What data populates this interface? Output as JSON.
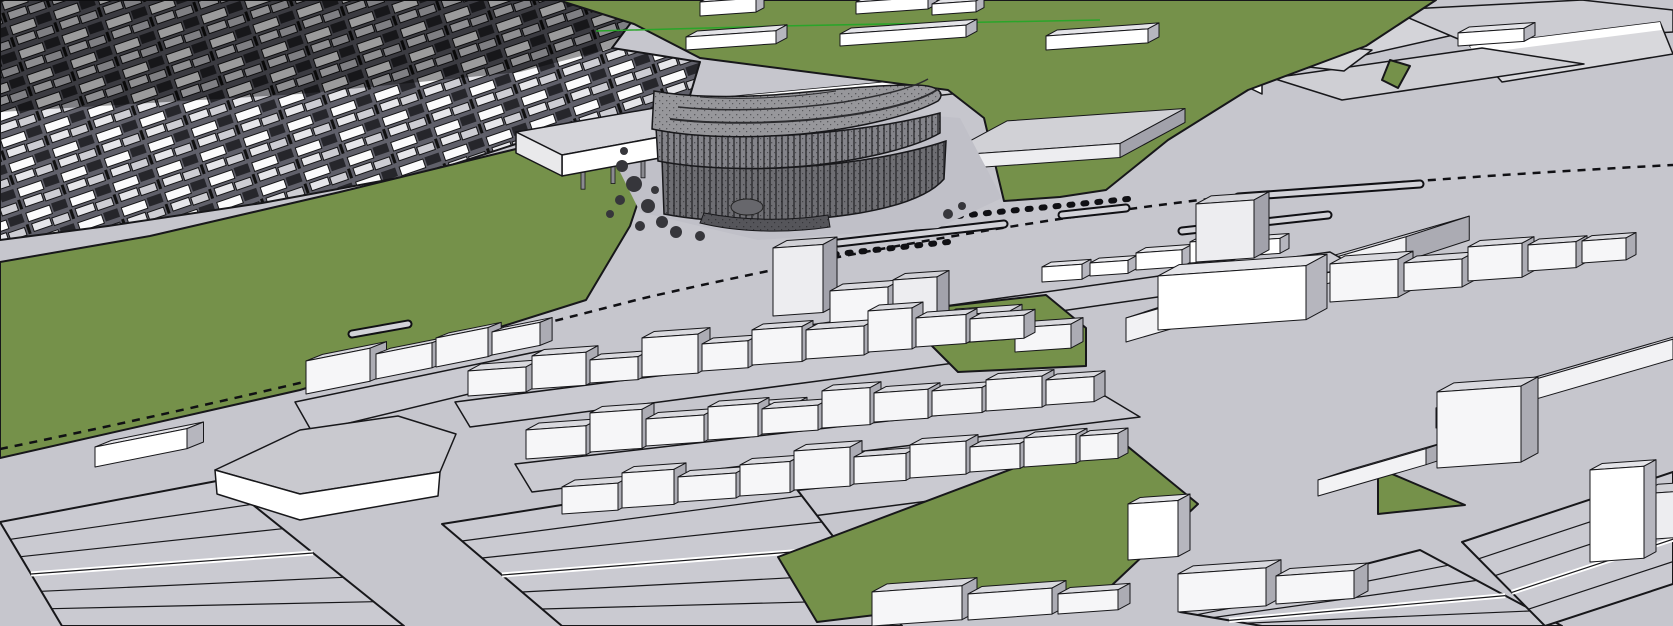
{
  "meta": {
    "description": "3D city massing model viewport with one detailed dark building among white block massing, green parks and gray streets",
    "view": "aerial perspective"
  },
  "colors": {
    "road": "#C6C6CD",
    "plot": "#CACAD1",
    "plaza": "#C0C0C8",
    "green": "#75914A",
    "outline": "#17171A",
    "axisGreen": "#2AA52A",
    "railBlack": "#101014",
    "denseOverlay": "#000000",
    "variants": {
      "d": {
        "t": "#D9D9DE",
        "f": "#F6F6F8",
        "s": "#ACACB4"
      },
      "w": {
        "t": "#E4E4E8",
        "f": "#FFFFFF",
        "s": "#B6B6BE"
      },
      "g": {
        "t": "#D1D1D6",
        "f": "#EDEDF0",
        "s": "#A2A2AB"
      },
      "G": {
        "t": "#CFCFD5",
        "f": "#F2F2F4",
        "s": "#ABABB3"
      },
      "b": {
        "t": "#DADAE0",
        "f": "#C8DEEC",
        "s": "#A8A8B0"
      }
    }
  },
  "scene": {
    "dense": {
      "name": "dense-neighborhood",
      "pts": "0,0 648,0 612,48 700,62 688,102 565,128 430,172 262,203 108,226 0,240",
      "darkPts": "0,0 648,0 612,48 520,72 300,94 0,112",
      "darkOpacity": 0.38
    },
    "regions": [
      {
        "name": "left-park",
        "pts": "0,262 150,236 340,192 520,148 592,133 658,142 630,226 586,300 300,390 0,458",
        "fill": "green",
        "stroke": true
      },
      {
        "name": "top-green-field",
        "pts": "558,0 1436,0 1366,46 1248,90 1168,140 1106,190 1060,197 1004,201 984,118 948,90 700,58 634,24",
        "fill": "green",
        "stroke": true
      },
      {
        "name": "top-right-green-patch",
        "pts": "1390,60 1410,66 1398,88 1382,80",
        "fill": "green",
        "stroke": true
      }
    ],
    "plaza": {
      "name": "detailed-building-plaza",
      "pts": "608,148 690,96 960,118 1002,198 938,228 758,240 640,212"
    },
    "farSlabs": [
      {
        "name": "far-slab",
        "pts": "1142,60 1380,12 1502,24 1272,76",
        "fill": "#D4D4D9",
        "stroke": true
      },
      {
        "name": "far-slab-highlight",
        "pts": "1142,60 1380,12 1384,20 1148,68",
        "fill": "#FFFFFF",
        "stroke": false
      },
      {
        "name": "far-slab",
        "pts": "1390,10 1582,0 1673,10 1673,32 1470,44",
        "fill": "#CCCCD2",
        "stroke": true
      },
      {
        "name": "far-slab",
        "pts": "1470,46 1660,22 1673,54 1502,82",
        "fill": "#D8D8DC",
        "stroke": true
      },
      {
        "name": "far-slab-highlight",
        "pts": "1470,46 1660,22 1662,30 1474,54",
        "fill": "#FFFFFF",
        "stroke": false
      },
      {
        "name": "far-slab",
        "pts": "1272,78 1482,48 1584,64 1342,100",
        "fill": "#CFCFD4",
        "stroke": true
      },
      {
        "name": "boomerang-building-roof",
        "pts": "1232,54 1296,42 1372,50 1344,71 1300,66 1262,83 1236,70",
        "fill": "#D6D6DA",
        "stroke": true
      },
      {
        "name": "boomerang-building-front",
        "pts": "1236,70 1262,83 1262,94 1237,82",
        "fill": "#FFFFFF",
        "stroke": true
      },
      {
        "name": "back-slab-roof",
        "pts": "695,100 930,78 970,92 735,118",
        "fill": "#CFCFD4",
        "stroke": true
      },
      {
        "name": "back-slab-roof-highlight",
        "pts": "695,100 930,78 932,84 698,107",
        "fill": "#FFFFFF",
        "stroke": false
      }
    ],
    "rail": {
      "name": "railway-line",
      "path": "M0,449 C200,408 420,356 640,299 C800,262 1000,224 1200,200 C1380,182 1540,172 1673,165",
      "dash": "8 7"
    },
    "medians": [
      [
        838,
        243,
        1004,
        224
      ],
      [
        1062,
        215,
        1126,
        208
      ],
      [
        1182,
        231,
        1328,
        215
      ],
      [
        1238,
        197,
        1420,
        184
      ],
      [
        352,
        334,
        408,
        324
      ]
    ],
    "dashChains": [
      [
        958,
        216,
        1128,
        199
      ],
      [
        792,
        259,
        948,
        242
      ]
    ],
    "axisLine": {
      "name": "green-axis-line",
      "pts": "596,31 780,26 1100,20"
    },
    "piloti": {
      "name": "piloti-slab-building",
      "top": "516,132 706,99 752,120 562,155",
      "front": "562,155 752,120 752,141 562,176",
      "end": "516,132 562,155 562,176 516,153",
      "colEdge": [
        566,
        170,
        746,
        136
      ],
      "nCols": 6
    },
    "detailed": {
      "name": "detailed-building",
      "shapes": [
        {
          "d": "M664,214 C720,225 800,223 860,213 C906,205 932,193 944,179 L946,141 C910,153 858,163 798,167 C738,171 696,167 662,159 Z",
          "fill": "#6E6E73",
          "louv": true,
          "sw": 1.5
        },
        {
          "d": "M658,161 C700,169 760,171 816,165 C868,159 916,147 940,133 L940,113 C902,123 850,131 792,135 C736,138 694,135 656,127 Z",
          "fill": "#84848A",
          "louv": true,
          "sw": 1.5
        },
        {
          "d": "M652,129 C690,137 744,139 802,134 C862,128 912,115 938,101 C946,93 938,85 914,85 C868,85 824,91 772,95 C722,98 682,96 654,91 Z",
          "fill": "#97979B",
          "louv": false,
          "sw": 1.5
        },
        {
          "d": "M700,223 C740,233 790,233 830,227 L828,215 C790,221 746,221 704,213 Z",
          "fill": "#55555A",
          "louv": false,
          "sw": 1
        }
      ],
      "ridges": [
        {
          "d": "M670,119 C720,125 790,124 850,115 C896,108 926,98 938,89",
          "sw": 2
        },
        {
          "d": "M678,107 C724,112 788,110 844,102 C886,95 914,87 928,79",
          "sw": 1.5
        },
        {
          "d": "M700,97 C740,100 790,98 836,91",
          "sw": 1
        }
      ],
      "drum": {
        "cx": 747,
        "cy": 207,
        "rx": 16,
        "ry": 8
      }
    },
    "trees": [
      [
        622,
        166,
        6
      ],
      [
        634,
        184,
        8
      ],
      [
        620,
        200,
        5
      ],
      [
        648,
        206,
        7
      ],
      [
        662,
        222,
        6
      ],
      [
        640,
        226,
        5
      ],
      [
        676,
        232,
        6
      ],
      [
        700,
        236,
        5
      ],
      [
        624,
        151,
        4
      ],
      [
        655,
        190,
        4
      ],
      [
        610,
        214,
        4
      ],
      [
        688,
        156,
        5
      ],
      [
        948,
        214,
        5
      ],
      [
        962,
        206,
        4
      ]
    ],
    "boxesBack": [
      [
        1,
        686,
        50,
        90,
        22,
        13,
        "w"
      ],
      [
        1,
        840,
        46,
        126,
        22,
        12,
        "w"
      ],
      [
        1,
        1046,
        50,
        102,
        22,
        14,
        "w"
      ],
      [
        1,
        1458,
        46,
        66,
        22,
        13,
        "w"
      ],
      [
        1,
        700,
        16,
        56,
        16,
        14,
        "w"
      ],
      [
        1,
        856,
        14,
        72,
        18,
        12,
        "w"
      ],
      [
        1,
        932,
        15,
        44,
        16,
        11,
        "w"
      ],
      [
        1,
        942,
        170,
        178,
        130,
        14,
        "g"
      ],
      [
        3,
        1126,
        342,
        280,
        115,
        24,
        "G"
      ]
    ],
    "plots": [
      {
        "name": "block-plot",
        "pts": "760,332 1330,252 1358,268 778,352"
      },
      {
        "name": "block-plot",
        "pts": "455,402 1000,332 1038,352 470,427"
      },
      {
        "name": "block-plot",
        "pts": "515,464 1105,396 1140,417 532,492"
      },
      {
        "name": "block-plot",
        "pts": "548,520 1122,452 1152,472 566,548"
      },
      {
        "name": "block-plot",
        "pts": "295,402 545,350 580,367 312,432"
      }
    ],
    "stripRegions": [
      {
        "name": "subdivided-plots",
        "quad": [
          [
            0,
            522
          ],
          [
            222,
            480
          ],
          [
            404,
            626
          ],
          [
            62,
            626
          ]
        ],
        "n": 6
      },
      {
        "name": "subdivided-plots",
        "quad": [
          [
            442,
            524
          ],
          [
            782,
            470
          ],
          [
            902,
            626
          ],
          [
            562,
            626
          ]
        ],
        "n": 6
      },
      {
        "name": "subdivided-plots",
        "quad": [
          [
            1180,
            612
          ],
          [
            1420,
            550
          ],
          [
            1562,
            626
          ],
          [
            1262,
            626
          ]
        ],
        "n": 5
      },
      {
        "name": "subdivided-plots",
        "quad": [
          [
            1462,
            542
          ],
          [
            1673,
            472
          ],
          [
            1673,
            584
          ],
          [
            1545,
            626
          ]
        ],
        "n": 5
      }
    ],
    "foreGreens": [
      {
        "name": "center-green-block",
        "pts": "948,306 1046,295 1086,328 1086,366 958,372 918,332"
      },
      {
        "name": "bottom-green-field",
        "pts": "778,557 1110,432 1198,504 1110,587 817,622"
      },
      {
        "name": "bottom-right-green-sliver",
        "pts": "1378,468 1465,505 1378,514"
      }
    ],
    "whiteSlabBuilding": [
      {
        "name": "flat-building-roof",
        "pts": "215,470 300,430 398,416 456,434 440,472 300,494",
        "fill": "#C9C9CF",
        "stroke": true
      },
      {
        "name": "flat-building-front",
        "pts": "215,470 300,494 440,472 438,496 300,520 217,494",
        "fill": "#FFFFFF",
        "stroke": true
      }
    ],
    "boxesFront": [
      [
        1,
        1042,
        282,
        40,
        18,
        15,
        "w"
      ],
      [
        1,
        1090,
        276,
        38,
        18,
        13,
        "w"
      ],
      [
        1,
        1136,
        270,
        46,
        20,
        17,
        "w"
      ],
      [
        1,
        1190,
        263,
        44,
        18,
        21,
        "w"
      ],
      [
        1,
        1242,
        256,
        38,
        18,
        15,
        "w"
      ],
      [
        1,
        773,
        316,
        50,
        28,
        68,
        "g"
      ],
      [
        1,
        830,
        327,
        58,
        26,
        36,
        "d"
      ],
      [
        1,
        893,
        336,
        44,
        24,
        56,
        "g"
      ],
      [
        1,
        943,
        344,
        66,
        26,
        28,
        "d"
      ],
      [
        1,
        1015,
        352,
        56,
        24,
        24,
        "d"
      ],
      [
        1,
        1196,
        262,
        58,
        30,
        58,
        "g"
      ],
      [
        1,
        1330,
        302,
        68,
        30,
        38,
        "d"
      ],
      [
        1,
        1404,
        291,
        58,
        26,
        28,
        "d"
      ],
      [
        1,
        1468,
        281,
        54,
        24,
        34,
        "d"
      ],
      [
        1,
        1528,
        271,
        48,
        22,
        26,
        "d"
      ],
      [
        1,
        1582,
        263,
        44,
        20,
        22,
        "d"
      ],
      [
        1,
        1158,
        330,
        148,
        42,
        54,
        "w"
      ],
      [
        3,
        1436,
        428,
        237,
        105,
        20,
        "G"
      ],
      [
        3,
        1318,
        496,
        108,
        56,
        16,
        "G"
      ],
      [
        1,
        468,
        396,
        58,
        26,
        25,
        "d"
      ],
      [
        1,
        532,
        389,
        54,
        24,
        33,
        "d"
      ],
      [
        1,
        590,
        383,
        48,
        22,
        23,
        "d"
      ],
      [
        1,
        642,
        377,
        56,
        24,
        39,
        "d"
      ],
      [
        1,
        702,
        371,
        46,
        22,
        27,
        "d"
      ],
      [
        1,
        752,
        365,
        50,
        22,
        35,
        "d"
      ],
      [
        1,
        806,
        359,
        58,
        24,
        29,
        "d"
      ],
      [
        1,
        868,
        352,
        44,
        22,
        41,
        "d"
      ],
      [
        1,
        916,
        347,
        50,
        22,
        29,
        "d"
      ],
      [
        1,
        970,
        342,
        54,
        22,
        23,
        "d"
      ],
      [
        1,
        758,
        418,
        40,
        18,
        13,
        "b"
      ],
      [
        1,
        526,
        459,
        60,
        26,
        29,
        "d"
      ],
      [
        1,
        590,
        452,
        52,
        24,
        39,
        "d"
      ],
      [
        1,
        646,
        446,
        58,
        24,
        27,
        "d"
      ],
      [
        1,
        708,
        440,
        50,
        22,
        33,
        "d"
      ],
      [
        1,
        762,
        434,
        56,
        24,
        25,
        "d"
      ],
      [
        1,
        822,
        428,
        48,
        22,
        37,
        "d"
      ],
      [
        1,
        874,
        422,
        54,
        24,
        29,
        "d"
      ],
      [
        1,
        932,
        416,
        50,
        22,
        25,
        "d"
      ],
      [
        1,
        986,
        411,
        56,
        24,
        31,
        "d"
      ],
      [
        1,
        1046,
        405,
        48,
        22,
        25,
        "d"
      ],
      [
        1,
        562,
        514,
        56,
        26,
        27,
        "d"
      ],
      [
        1,
        622,
        508,
        52,
        24,
        35,
        "d"
      ],
      [
        1,
        678,
        502,
        58,
        24,
        25,
        "d"
      ],
      [
        1,
        740,
        496,
        50,
        24,
        31,
        "d"
      ],
      [
        1,
        794,
        490,
        56,
        24,
        39,
        "d"
      ],
      [
        1,
        854,
        484,
        52,
        22,
        27,
        "d"
      ],
      [
        1,
        910,
        478,
        56,
        24,
        33,
        "d"
      ],
      [
        1,
        970,
        472,
        50,
        22,
        25,
        "d"
      ],
      [
        1,
        1024,
        467,
        52,
        22,
        29,
        "d"
      ],
      [
        1,
        1080,
        461,
        38,
        20,
        25,
        "d"
      ],
      [
        2,
        306,
        394,
        64,
        30,
        33,
        "d"
      ],
      [
        2,
        376,
        379,
        56,
        26,
        25,
        "d"
      ],
      [
        2,
        436,
        367,
        52,
        24,
        29,
        "d"
      ],
      [
        2,
        492,
        355,
        48,
        22,
        23,
        "d"
      ],
      [
        2,
        95,
        467,
        92,
        30,
        20,
        "w"
      ],
      [
        1,
        1128,
        560,
        50,
        24,
        56,
        "w"
      ],
      [
        1,
        1437,
        468,
        84,
        34,
        76,
        "d"
      ],
      [
        1,
        1640,
        540,
        60,
        36,
        46,
        "g"
      ],
      [
        1,
        1590,
        562,
        54,
        24,
        92,
        "w"
      ],
      [
        1,
        1178,
        612,
        88,
        30,
        38,
        "d"
      ],
      [
        1,
        1276,
        604,
        78,
        28,
        28,
        "d"
      ],
      [
        1,
        872,
        626,
        90,
        30,
        34,
        "d"
      ],
      [
        1,
        968,
        620,
        84,
        28,
        26,
        "d"
      ],
      [
        1,
        1058,
        614,
        60,
        24,
        20,
        "d"
      ]
    ]
  }
}
